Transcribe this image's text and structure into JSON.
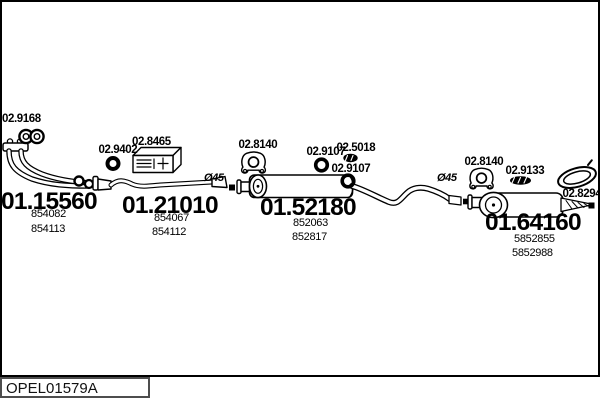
{
  "footer": {
    "code": "OPEL01579A"
  },
  "parts": {
    "front_pipe": {
      "number": "01.15560",
      "oem1": "854082",
      "oem2": "854113"
    },
    "center_pipe": {
      "number": "01.21010",
      "oem1": "854067",
      "oem2": "854112"
    },
    "middle_silencer": {
      "number": "01.52180",
      "oem1": "852063",
      "oem2": "852817"
    },
    "rear_silencer": {
      "number": "01.64160",
      "oem1": "5852855",
      "oem2": "5852988"
    }
  },
  "fittings": {
    "gasket_pair": {
      "number": "02.9168",
      "icon": "double-gasket-icon"
    },
    "ring_gasket": {
      "number": "02.9402",
      "icon": "ring-gasket-icon"
    },
    "bracket": {
      "number": "02.8465",
      "icon": "mounting-bracket-icon"
    },
    "hanger_front": {
      "number": "02.8140",
      "icon": "rubber-hanger-icon"
    },
    "ring_front": {
      "number": "02.9107",
      "icon": "ring-gasket-icon"
    },
    "clamp": {
      "number": "02.5018",
      "icon": "clamp-icon"
    },
    "ring_rear": {
      "number": "02.9107",
      "icon": "ring-gasket-icon"
    },
    "hanger_rear": {
      "number": "02.8140",
      "icon": "rubber-hanger-icon"
    },
    "flat_gasket": {
      "number": "02.9133",
      "icon": "flat-gasket-icon"
    },
    "tail_trim": {
      "number": "02.8294",
      "icon": "tail-trim-ring-icon"
    }
  },
  "annotations": {
    "diameter_front": "Ø45",
    "diameter_rear": "Ø45"
  },
  "colors": {
    "ink": "#000000",
    "footer_border": "#4d4d4d"
  }
}
